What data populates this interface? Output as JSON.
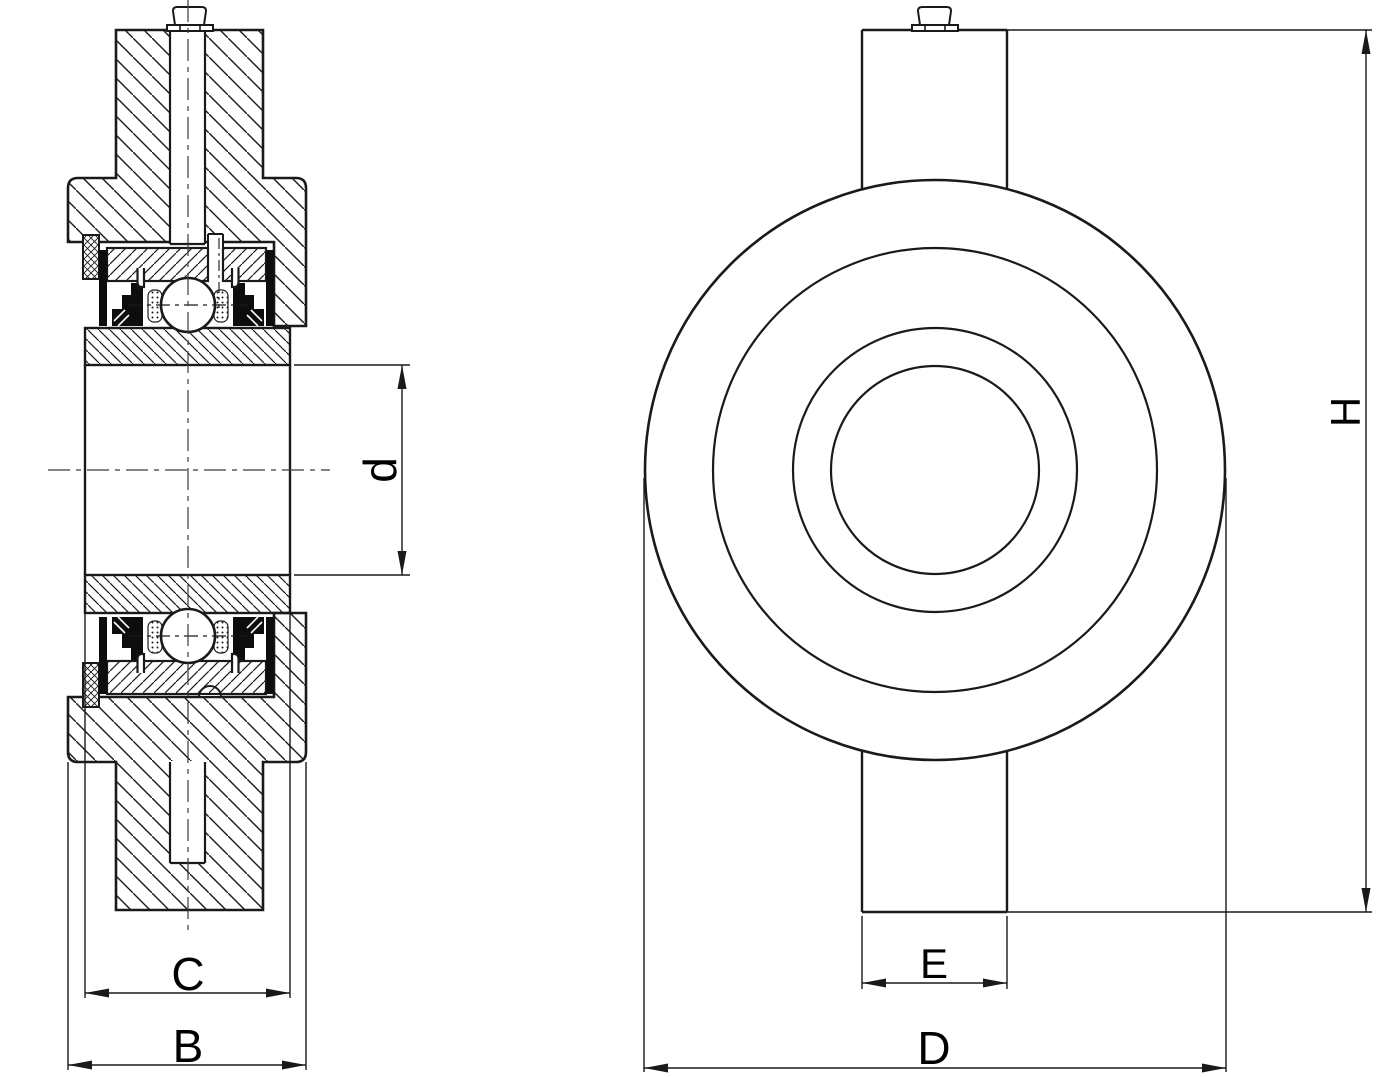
{
  "drawing": {
    "kind": "bearing-unit technical drawing, sectional side view and front view",
    "colors": {
      "line": "#1a1a1a",
      "background": "#ffffff",
      "seal_fill": "#0d0d0d"
    },
    "labels": {
      "bore_diameter": "d",
      "inner_ring_width": "C",
      "housing_width": "B",
      "slot_width": "E",
      "outer_diameter": "D",
      "total_height": "H"
    }
  }
}
